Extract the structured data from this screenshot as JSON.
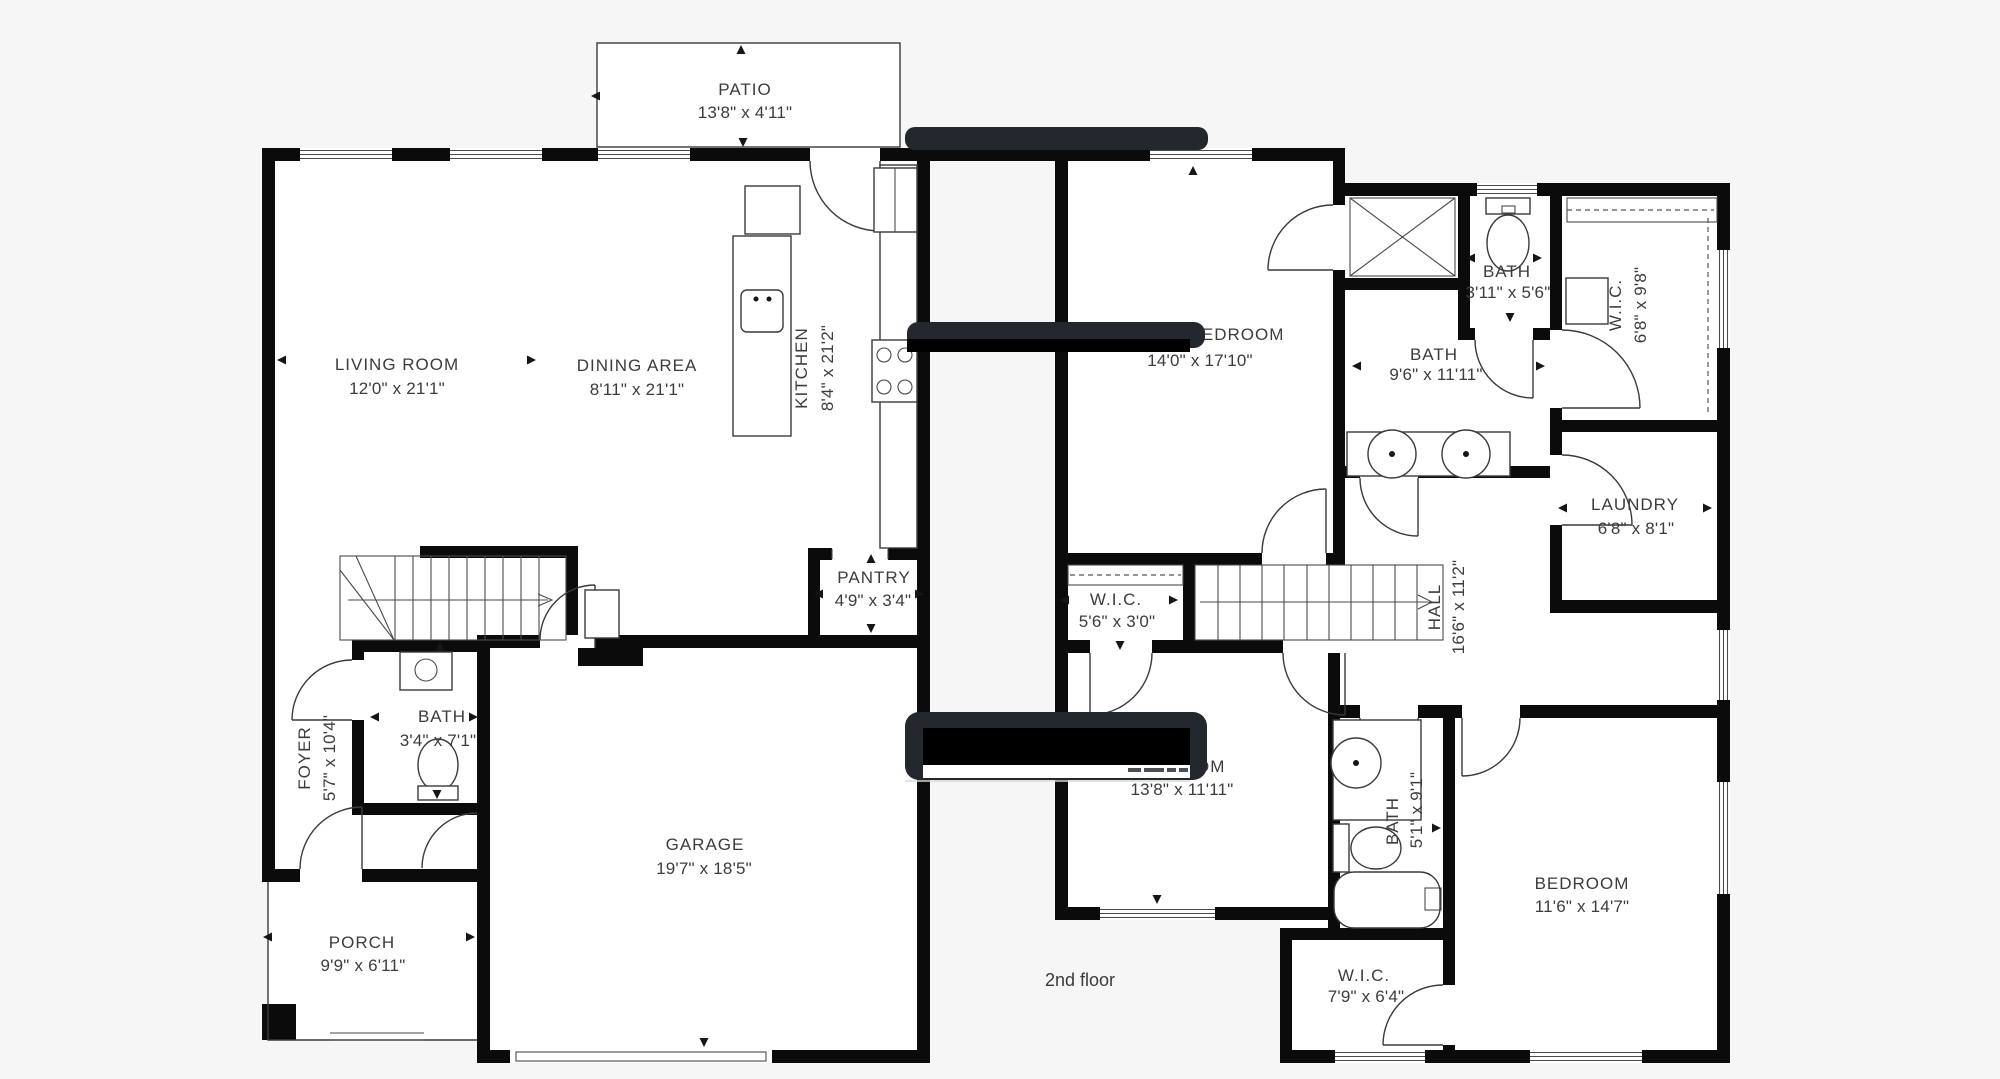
{
  "title": "Two-story house floor plan",
  "floor_label": "2nd floor",
  "floors": {
    "first": {
      "patio": {
        "name": "PATIO",
        "dims": "13'8\" x 4'11\""
      },
      "living_room": {
        "name": "LIVING ROOM",
        "dims": "12'0\" x 21'1\""
      },
      "dining_area": {
        "name": "DINING AREA",
        "dims": "8'11\" x 21'1\""
      },
      "kitchen": {
        "name": "KITCHEN",
        "dims": "8'4\" x 21'2\""
      },
      "pantry": {
        "name": "PANTRY",
        "dims": "4'9\" x 3'4\""
      },
      "foyer": {
        "name": "FOYER",
        "dims": "5'7\" x 10'4\""
      },
      "bath": {
        "name": "BATH",
        "dims": "3'4\" x 7'1\""
      },
      "garage": {
        "name": "GARAGE",
        "dims": "19'7\" x 18'5\""
      },
      "porch": {
        "name": "PORCH",
        "dims": "9'9\" x 6'11\""
      }
    },
    "second": {
      "bedroom_main": {
        "name": "BEDROOM",
        "dims": "14'0\" x 17'10\""
      },
      "bath_small": {
        "name": "BATH",
        "dims": "3'11\" x 5'6\""
      },
      "bath_main": {
        "name": "BATH",
        "dims": "9'6\" x 11'11\""
      },
      "wic_main": {
        "name": "W.I.C.",
        "dims": "6'8\" x 9'8\""
      },
      "laundry": {
        "name": "LAUNDRY",
        "dims": "6'8\" x 8'1\""
      },
      "wic_hall": {
        "name": "W.I.C.",
        "dims": "5'6\" x 3'0\""
      },
      "hall": {
        "name": "HALL",
        "dims": "16'6\" x 11'2\""
      },
      "bedroom_2": {
        "name": "BEDROOM",
        "dims": "13'8\" x 11'11\""
      },
      "bath_2": {
        "name": "BATH",
        "dims": "5'1\" x 9'1\""
      },
      "bedroom_3": {
        "name": "BEDROOM",
        "dims": "11'6\" x 14'7\""
      },
      "wic_3": {
        "name": "W.I.C.",
        "dims": "7'9\" x 6'4\""
      }
    }
  },
  "colors": {
    "background": "#f6f6f6",
    "room_fill": "#ffffff",
    "walls": "#0b0b0b",
    "lines": "#3a3a3a",
    "text": "#3c3c3c",
    "redaction_dark": "#23272e",
    "redaction_black": "#000000"
  }
}
